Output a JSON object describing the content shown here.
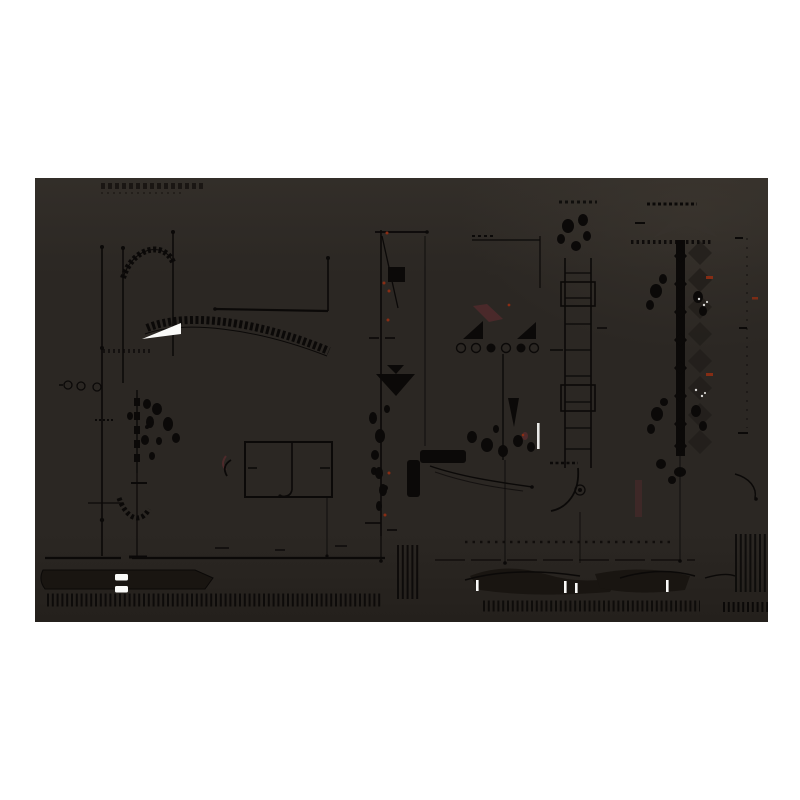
{
  "page": {
    "background": "#ffffff"
  },
  "artwork": {
    "x": 35,
    "y": 178,
    "width": 733,
    "height": 444,
    "kind": "dark inverted technical drawing plate, abstract line art, no legible text",
    "colors": {
      "page": "#ffffff",
      "bg": "#2b2723",
      "ink": "#0b0908",
      "smudge": "#1a1613",
      "midtone": "#221e1a",
      "lighten": "#3a352f",
      "mass": "#191511",
      "highlight": "#fafaf8",
      "rust": "#8a2d14",
      "maroon": "#4e2a2b"
    },
    "highlights": {
      "white_wedge": [
        107,
        145,
        146,
        163
      ],
      "equals_bars": [
        [
          80,
          396
        ],
        [
          80,
          408
        ]
      ],
      "white_ticks_x": [
        441,
        529,
        540,
        631
      ],
      "white_column_dash": [
        502,
        245
      ]
    },
    "red_specks": [
      [
        352,
        55
      ],
      [
        349,
        105
      ],
      [
        354,
        113
      ],
      [
        353,
        142
      ],
      [
        354,
        295
      ],
      [
        350,
        337
      ],
      [
        474,
        127
      ],
      [
        488,
        257
      ]
    ],
    "red_dashes": [
      [
        671,
        98
      ],
      [
        671,
        195
      ],
      [
        717,
        119
      ]
    ]
  }
}
